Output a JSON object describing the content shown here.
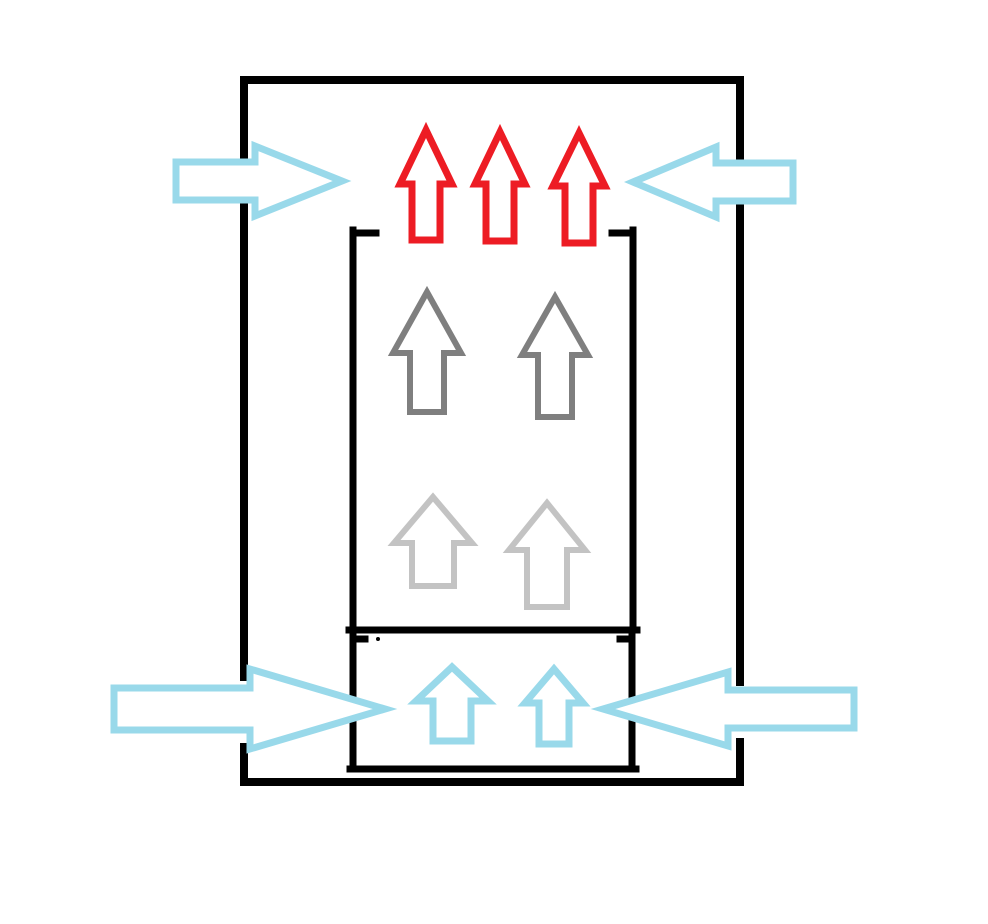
{
  "canvas": {
    "width": 988,
    "height": 924,
    "background": "#ffffff"
  },
  "palette": {
    "black": "#000000",
    "red": "#ed1c24",
    "gray": "#7f7f7f",
    "light_gray": "#c3c3c3",
    "light_blue": "#99d9ea",
    "white": "#ffffff"
  },
  "figure": {
    "kind": "freehand airflow diagram",
    "structures": [
      {
        "id": "outer-enclosure",
        "shape": "rectangle with four wall openings",
        "color_ref": "black"
      },
      {
        "id": "inner-chamber",
        "shape": "open-top rectangle with corner stubs",
        "color_ref": "black"
      },
      {
        "id": "base-chamber",
        "shape": "open-top rectangle with corner stubs",
        "color_ref": "black"
      }
    ],
    "arrow_groups": [
      {
        "id": "top-outflow-arrows",
        "count": 3,
        "direction": "up",
        "color_ref": "red"
      },
      {
        "id": "inner-upper-flow-arrows",
        "count": 2,
        "direction": "up",
        "color_ref": "gray"
      },
      {
        "id": "inner-lower-flow-arrows",
        "count": 2,
        "direction": "up",
        "color_ref": "light_gray"
      },
      {
        "id": "top-inlet-arrows",
        "count": 2,
        "direction": "inward horizontal",
        "color_ref": "light_blue"
      },
      {
        "id": "bottom-inlet-arrows",
        "count": 2,
        "direction": "inward horizontal",
        "color_ref": "light_blue"
      },
      {
        "id": "base-upflow-arrows",
        "count": 2,
        "direction": "up",
        "color_ref": "light_blue"
      }
    ]
  }
}
